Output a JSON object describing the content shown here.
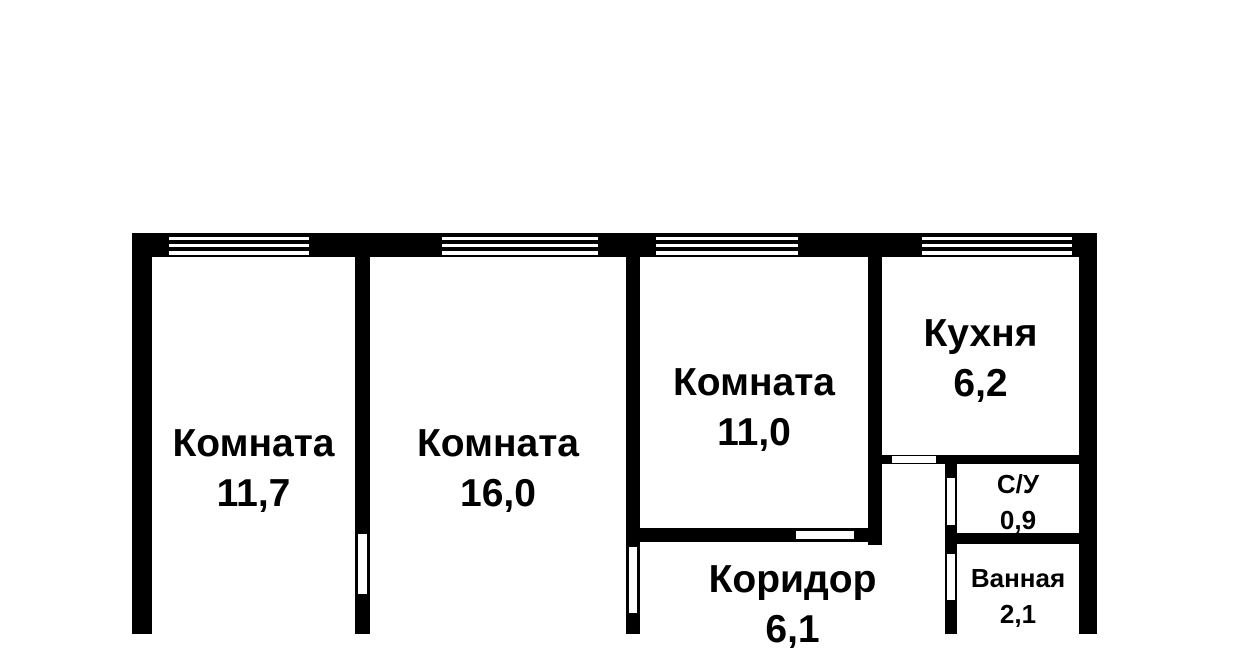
{
  "plan": {
    "type": "apartment-floor-plan",
    "background_color": "#ffffff",
    "wall_color": "#000000",
    "text_color": "#000000",
    "rooms": [
      {
        "id": "room-1",
        "name": "Комната",
        "area": "11,7"
      },
      {
        "id": "room-2",
        "name": "Комната",
        "area": "16,0"
      },
      {
        "id": "room-3",
        "name": "Комната",
        "area": "11,0"
      },
      {
        "id": "kitchen",
        "name": "Кухня",
        "area": "6,2"
      },
      {
        "id": "wc",
        "name": "С/У",
        "area": "0,9"
      },
      {
        "id": "bathroom",
        "name": "Ванная",
        "area": "2,1"
      },
      {
        "id": "corridor",
        "name": "Коридор",
        "area": "6,1"
      }
    ]
  }
}
